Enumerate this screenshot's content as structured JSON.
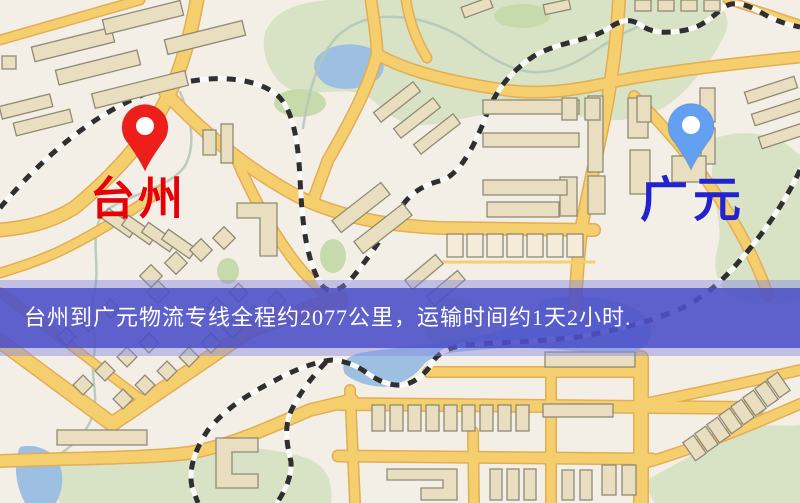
{
  "map": {
    "origin_label": "台州",
    "destination_label": "广元"
  },
  "banner": {
    "text": "台州到广元物流专线全程约2077公里，运输时间约1天2小时."
  },
  "icons": {
    "origin": "red-map-pin-icon",
    "destination": "blue-map-pin-icon"
  },
  "colors": {
    "map_bg": "#f4efe6",
    "origin_pin": "#ee1f1b",
    "destination_pin": "#64a0f2",
    "pin_hole": "#ffffff",
    "origin_label_color": "#e60008",
    "destination_label_color": "#2222cf",
    "banner_bg": "rgba(72,76,198,0.82)",
    "banner_fringe": "rgba(130,133,226,0.45)",
    "banner_text": "#ffffff",
    "road": "#f5cf6e",
    "road_casing": "#e2ad55",
    "railway": "#2f2f2f",
    "water": "#9dbfe2",
    "park": "#d7e3c4",
    "park_dark": "#c7daac",
    "building": "#e9dfc0",
    "building_light": "#f4ecd8",
    "building_outline": "#8f8a76",
    "stream": "#b5c6b8"
  }
}
